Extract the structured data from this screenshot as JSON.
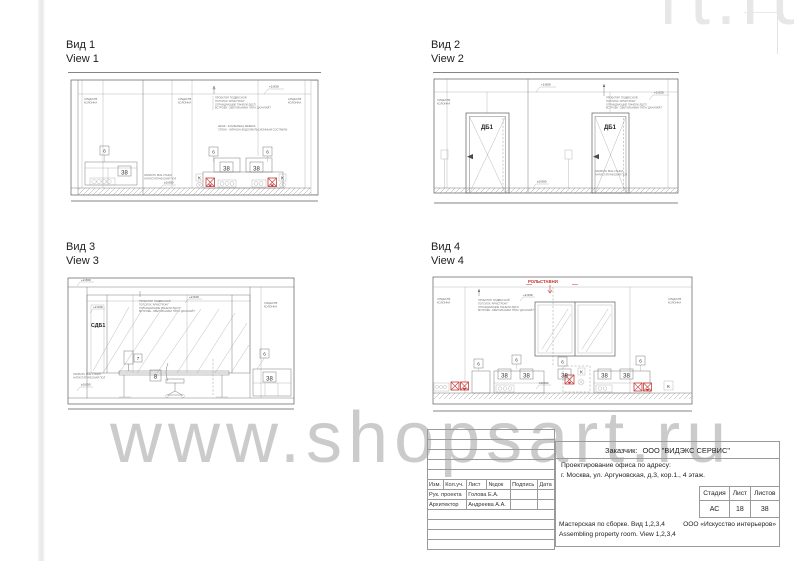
{
  "watermark": {
    "main": "www.shopsart.ru",
    "corner_fragment": "rt.ru"
  },
  "views": [
    {
      "name": "Вид 1",
      "name_en": "View 1",
      "elev_top": "+2.830",
      "elev_floor": "±0.000",
      "col_label": [
        "СУЩЕСТВ.",
        "КОЛОННА"
      ],
      "note_top": [
        "ПРОЕКТИР. ПОДВЕСНОЙ",
        "ПОТОЛОК 'АРМСТРОНГ'",
        "ОГРАЖДАЮЩИЕ ПАНЕЛИ ЛДСП",
        "ВСТРОЕН. СВЕТИЛЬНИКИ ТИПА 'ДАУНЛАЙТ'"
      ],
      "note_mid": [
        "ШКАФ - КОНФЕРЕНЦ МЕБЕЛЬ",
        "СТЕНА - ОКРАСКА ВОДОЭМУЛЬСИОННЫМ СОСТАВОМ"
      ],
      "note_floor": [
        "ЗАКРЫТЬ ВСЕ СТЫКИ",
        "АНТИСТАТИЧЕСКИЙ ПОЛ"
      ],
      "badge6": "6",
      "badge38": "38",
      "badgeK": "К"
    },
    {
      "name": "Вид 2",
      "name_en": "View 2",
      "door_label": "ДБ1",
      "elev_mid": "+2.800",
      "elev_top": "+2.830",
      "elev_floor": "±0.000",
      "col_label": [
        "СУЩЕСТВ.",
        "КОЛОННА"
      ],
      "note_top": [
        "ПРОЕКТИР. ПОДВЕСНОЙ",
        "ПОТОЛОК 'АРМСТРОНГ'",
        "ОГРАЖДАЮЩИЕ ПАНЕЛИ ЛДСП",
        "ВСТРОЕН. СВЕТИЛЬНИКИ ТИПА 'ДАУНЛАЙТ'"
      ],
      "note_floor": [
        "ЗАКРЫТЬ ВСЕ СТЫКИ",
        "АНТИСТАТИЧЕСКИЙ ПОЛ"
      ]
    },
    {
      "name": "Вид 3",
      "name_en": "View 3",
      "door_label": "СДБ1",
      "elev_top": "+2.800",
      "elev_mid": "+2.630",
      "elev_floor": "±0.000",
      "col_label": [
        "СУЩЕСТВ.",
        "КОЛОННА"
      ],
      "note_top": [
        "ПРОЕКТИР. ПОДВЕСНОЙ",
        "ПОТОЛОК 'АРМСТРОНГ'",
        "ОГРАЖДАЮЩИЕ ПАНЕЛИ ЛДСП",
        "ВСТРОЕН. СВЕТИЛЬНИКИ ТИПА 'ДАУНЛАЙТ'"
      ],
      "note_floor": [
        "ЗАКРЫТЬ ВСЕ СТЫКИ",
        "АНТИСТАТИЧЕСКИЙ ПОЛ"
      ],
      "badge7": "7",
      "badge8": "8",
      "badge6": "6",
      "badge38": "38"
    },
    {
      "name": "Вид 4",
      "name_en": "View 4",
      "red_label": "РОЛЬСТАВНИ",
      "elev_mid": "+2.630",
      "elev_floor": "±0.000",
      "col_label": [
        "СУЩЕСТВ.",
        "КОЛОННА"
      ],
      "note_top": [
        "ПРОЕКТИР. ПОДВЕСНОЙ",
        "ПОТОЛОК 'АРМСТРОНГ'",
        "ОГРАЖДАЮЩИЕ ПАНЕЛИ ЛДСП",
        "ВСТРОЕН. СВЕТИЛЬНИКИ ТИПА 'ДАУНЛАЙТ'"
      ],
      "badge6": "6",
      "badge38": "38",
      "badgeK": "К"
    }
  ],
  "title_block": {
    "customer_label": "Заказчик:",
    "customer": "ООО \"ВИДЭКС СЕРВИС\"",
    "project_line1": "Проектирование офиса по адресу:",
    "project_line2": "г. Москва, ул. Аргуновская, д.3, кор.1., 4 этаж.",
    "stage": {
      "h1": "Стадия",
      "h2": "Лист",
      "h3": "Листов",
      "v1": "АС",
      "v2": "18",
      "v3": "38"
    },
    "desc_ru": "Мастерская по сборке. Вид 1,2,3,4",
    "company": "ООО «Искусство интерьеров»",
    "desc_en": "Assembling property room. View 1,2,3,4",
    "rev": {
      "headers": [
        "Изм.",
        "Кол.уч.",
        "Лист",
        "№док",
        "Подпись",
        "Дата"
      ],
      "rows": [
        {
          "role": "Рук. проекта",
          "person": "Голова Е.А."
        },
        {
          "role": "Архитектор",
          "person": "Андреева А.А."
        }
      ]
    }
  }
}
